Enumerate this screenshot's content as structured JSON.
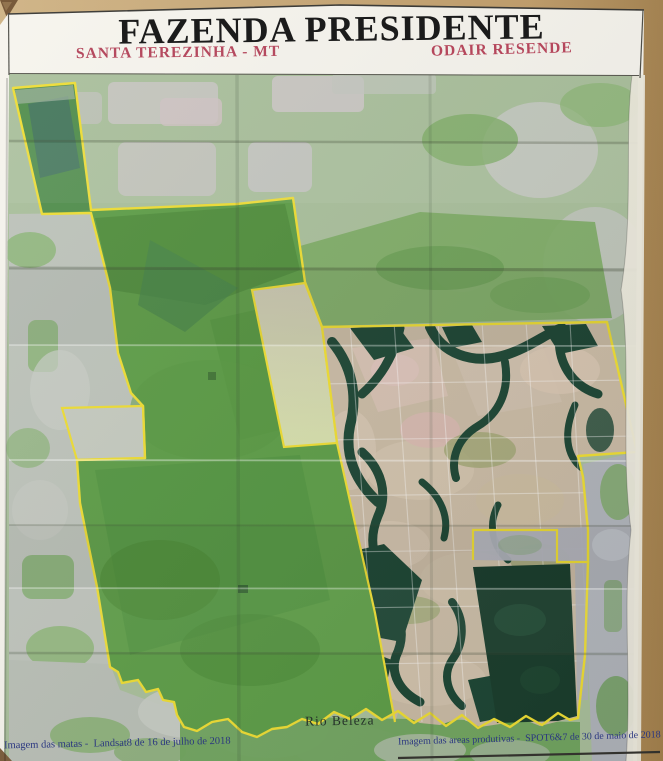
{
  "header": {
    "title": "FAZENDA PRESIDENTE",
    "subtitle_left": "SANTA TEREZINHA - MT",
    "subtitle_right": "ODAIR RESENDE"
  },
  "map": {
    "river_label": "Rio Beleza"
  },
  "footer": {
    "left_caption": "Imagem das matas -  Landsat8 de 16 de julho de 2018",
    "right_caption": "Imagem das areas produtivas -  SPOT6&7 de 30 de maio de 2018"
  },
  "colors": {
    "title_text": "#1b1b1b",
    "subtitle_text": "#b54a5f",
    "caption_text": "#2a3680",
    "river_label_text": "#25312a",
    "boundary_yellow": "#eedd33",
    "forest_green": "#5d9d47",
    "spot_tan": "#c9baa4",
    "dark_forest": "#1a3d2c",
    "table_background": "#c09c68"
  }
}
